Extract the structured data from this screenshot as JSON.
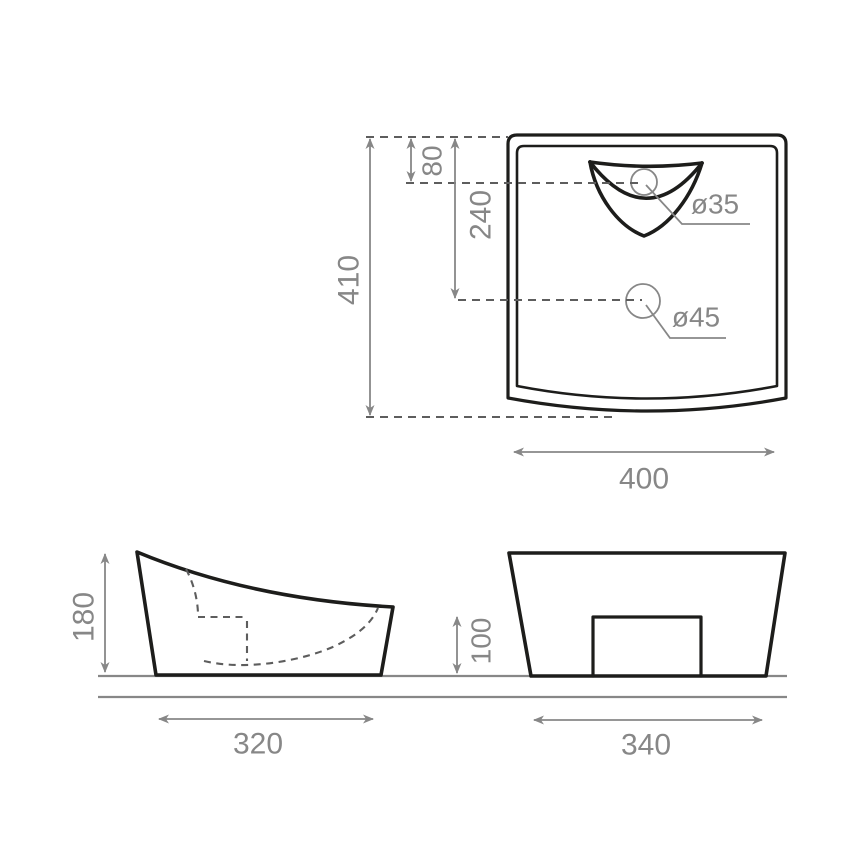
{
  "drawing": {
    "type": "technical-drawing-washbasin",
    "top_view": {
      "overall_height": "410",
      "tap_hole_offset": "80",
      "drain_hole_offset": "240",
      "width": "400",
      "tap_hole_diameter": "ø35",
      "drain_hole_diameter": "ø45"
    },
    "side_view": {
      "height": "180",
      "base_width": "320"
    },
    "front_view": {
      "pedestal_height": "100",
      "base_width": "340"
    },
    "colors": {
      "outline": "#1d1d1b",
      "dimension": "#878787",
      "hidden_line": "#5d5d5d",
      "background": "#ffffff"
    }
  }
}
